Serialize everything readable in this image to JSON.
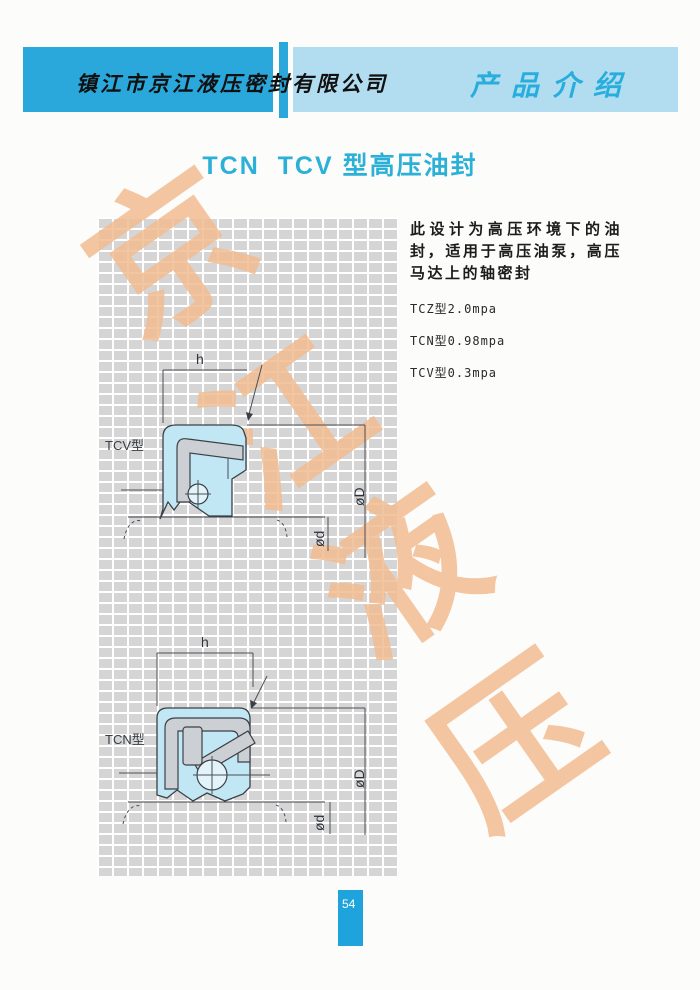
{
  "header": {
    "company": "镇江市京江液压密封有限公司",
    "section": "产品介绍"
  },
  "title": "TCN  TCV 型高压油封",
  "description": "此设计为高压环境下的油封，适用于高压油泵，高压马达上的轴密封",
  "specs": [
    "TCZ型2.0mpa",
    "TCN型0.98mpa",
    "TCV型0.3mpa"
  ],
  "diagrams": {
    "tcv": {
      "label": "TCV型",
      "dim_width": "h",
      "dim_outer": "øD",
      "dim_inner": "ød"
    },
    "tcn": {
      "label": "TCN型",
      "dim_width": "h",
      "dim_outer": "øD",
      "dim_inner": "ød"
    }
  },
  "watermark": {
    "chars": [
      "京",
      "江",
      "液",
      "压"
    ]
  },
  "page_number": "54",
  "colors": {
    "header_dark_blue": "#2aa7db",
    "header_light_blue": "#b2ddf1",
    "title_cyan": "#2bb0d8",
    "section_cyan": "#28aedc",
    "watermark_orange": "#f2bd92",
    "grid_gray": "#d5d5d5",
    "seal_blue": "#c1e7f5",
    "metal_gray": "#ccd0d4",
    "page_num_blue": "#1ea3dc"
  }
}
